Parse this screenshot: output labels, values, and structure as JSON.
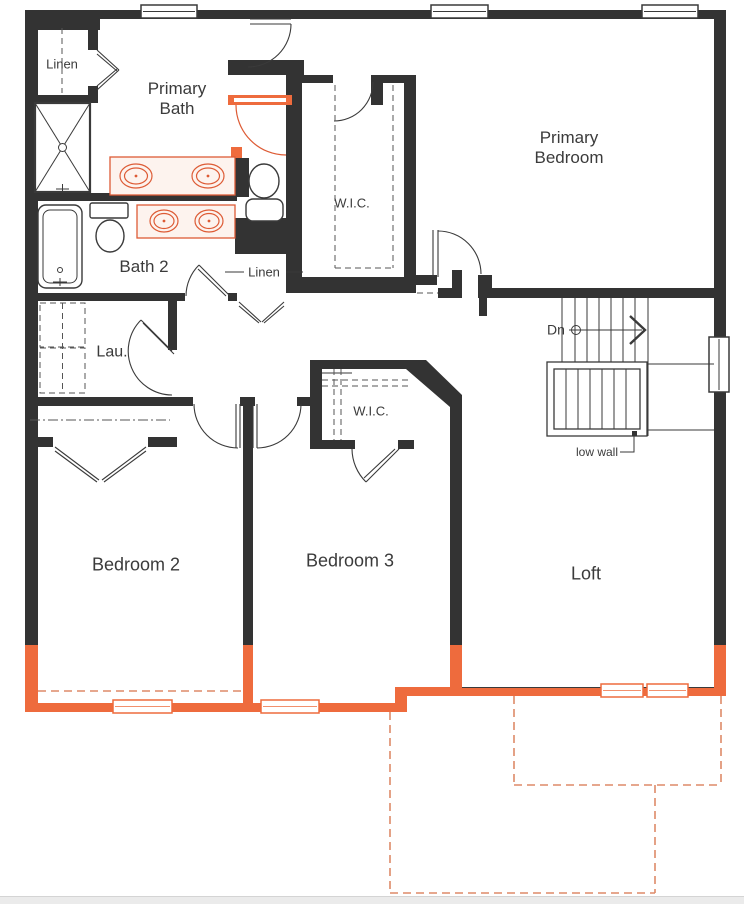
{
  "floor_plan": {
    "rooms": {
      "primary_bath": "Primary Bath",
      "primary_bedroom": "Primary Bedroom",
      "wic_primary": "W.I.C.",
      "bath_2": "Bath 2",
      "laundry": "Lau.",
      "bedroom_2": "Bedroom 2",
      "bedroom_3": "Bedroom 3",
      "wic_bedroom3": "W.I.C.",
      "loft": "Loft"
    },
    "closets": {
      "linen_upper": "Linen",
      "linen_hall": "Linen"
    },
    "stairs": {
      "direction_label": "Dn",
      "note": "low wall"
    },
    "colors": {
      "wall": "#333333",
      "orange": "#EE6B3D",
      "dashorange": "#DE8A68",
      "fixture": "#DD5B35"
    }
  }
}
